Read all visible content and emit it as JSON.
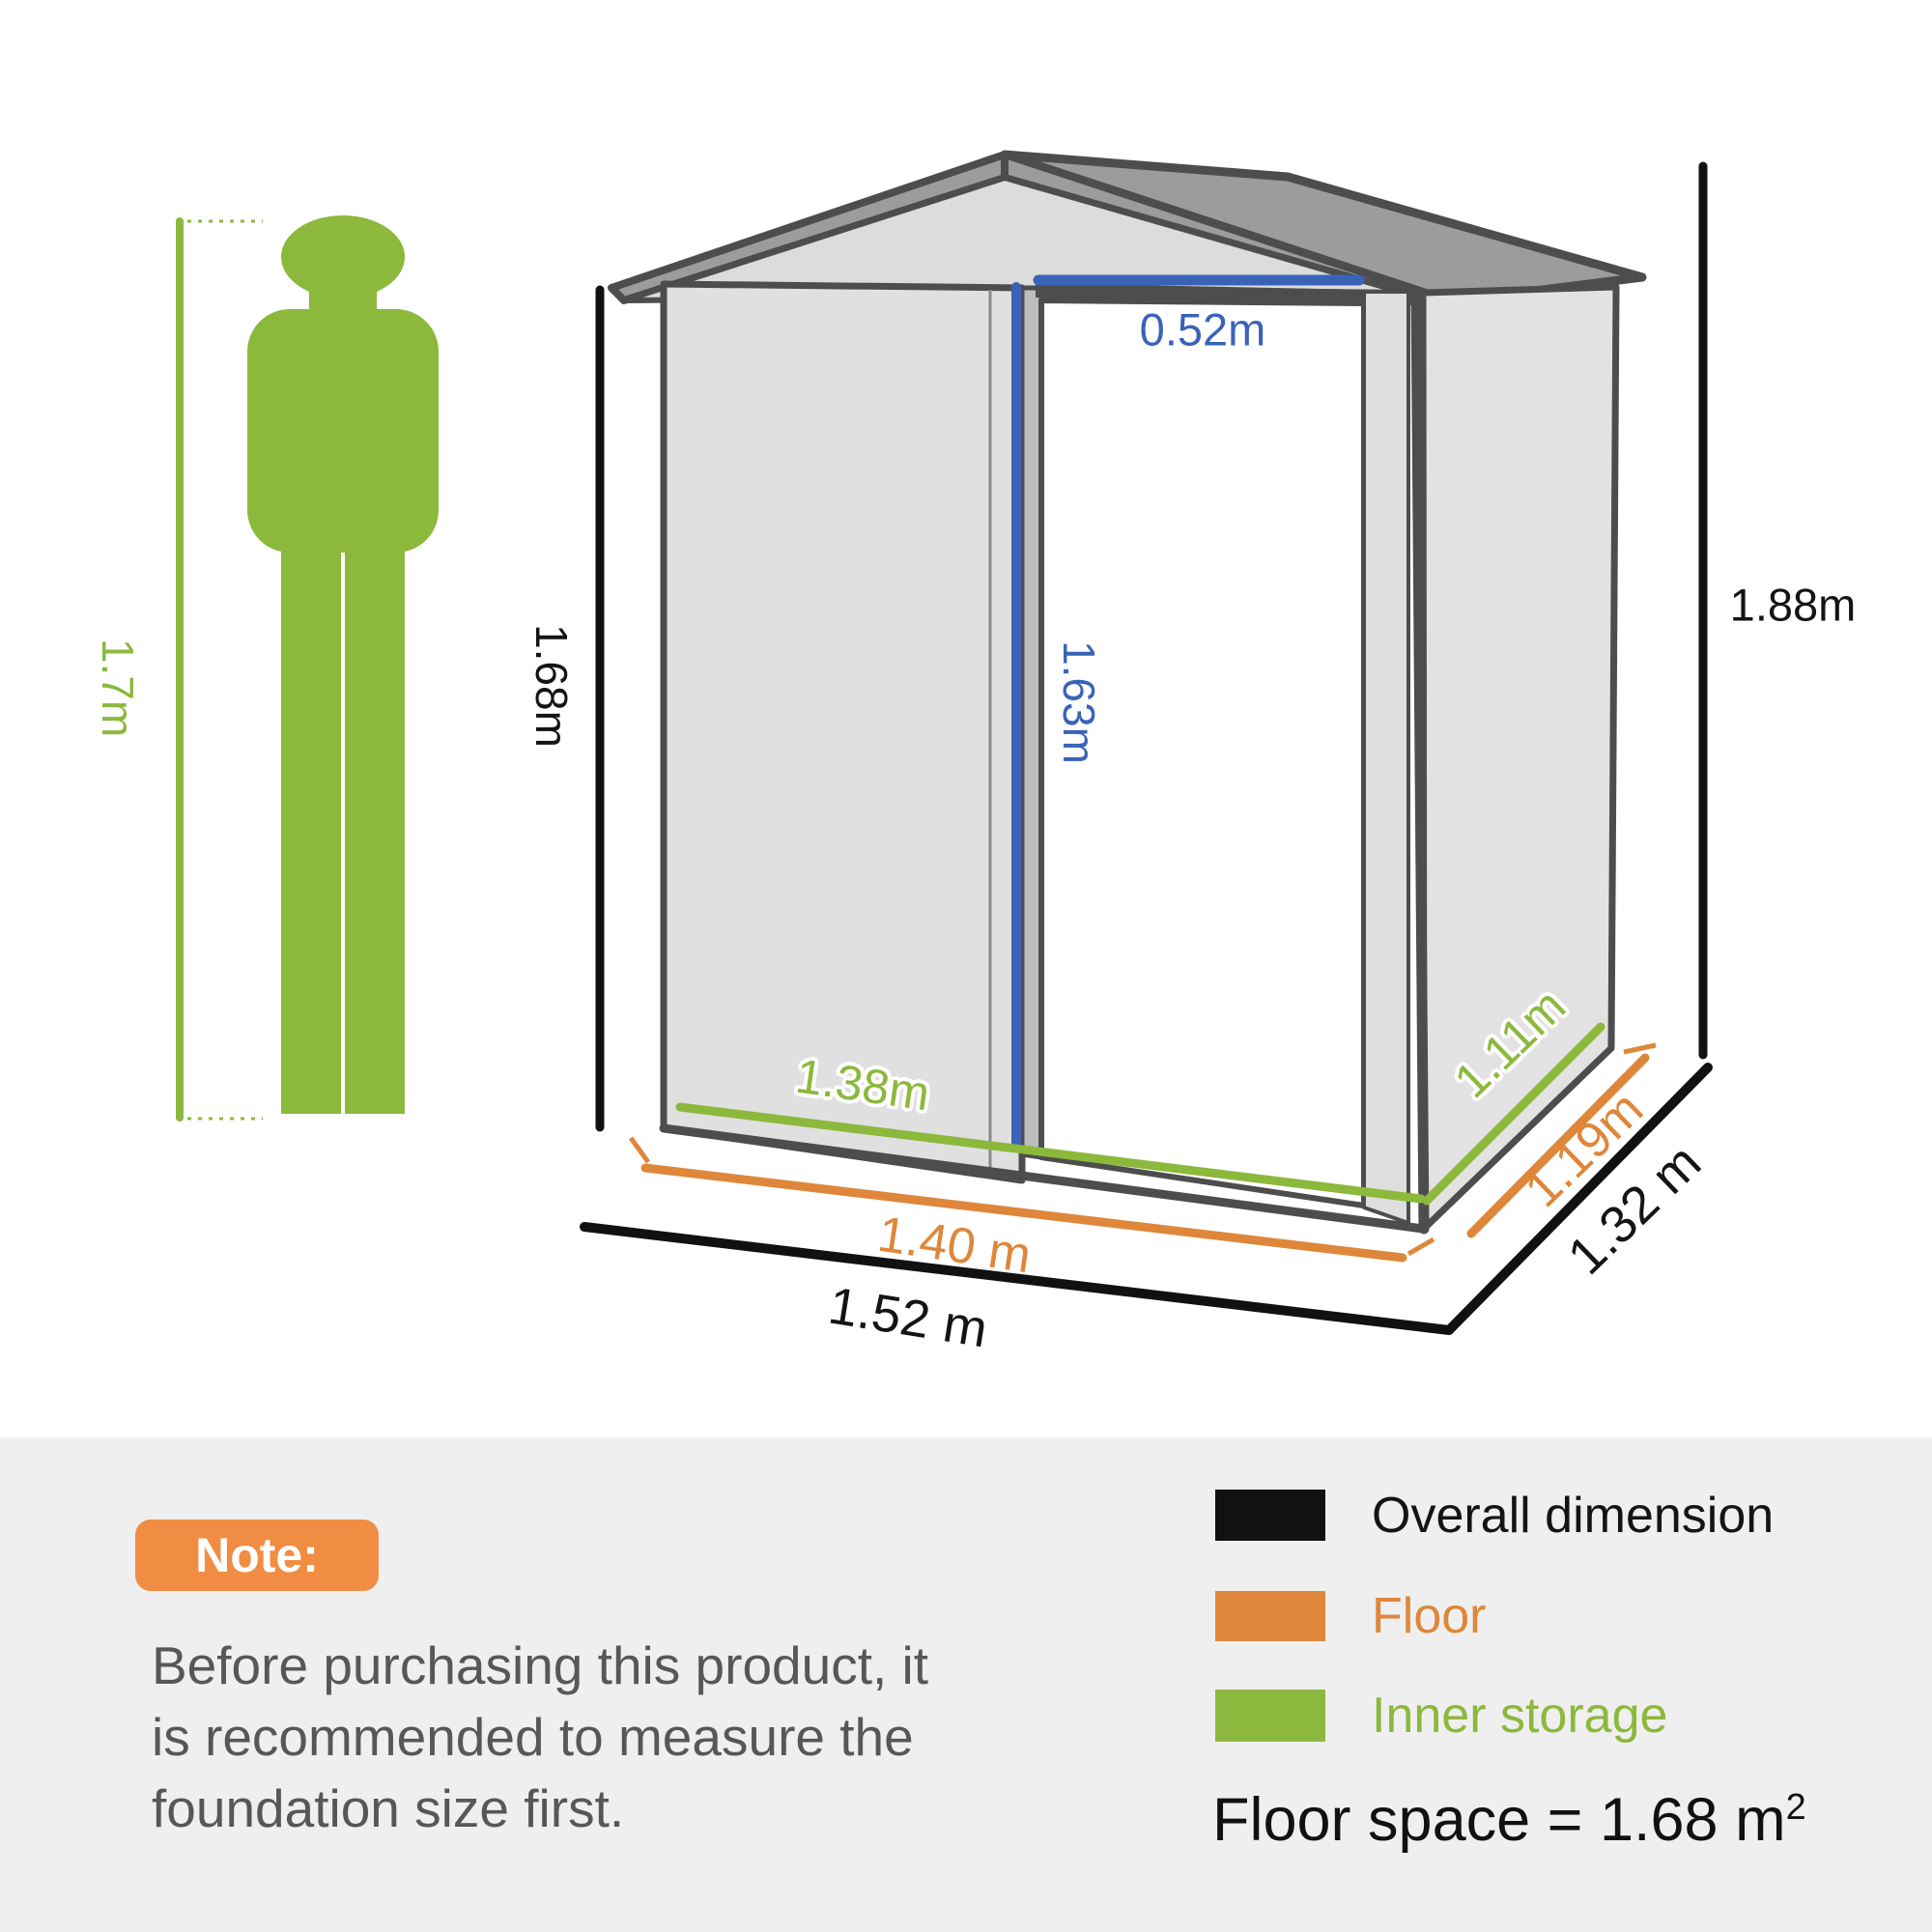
{
  "figure": {
    "height_label": "1.7m"
  },
  "dimensions": {
    "door_width": "0.52m",
    "inner_height": "1.68m",
    "door_height": "1.63m",
    "overall_height": "1.88m",
    "inner_width": "1.38m",
    "floor_width": "1.40 m",
    "overall_width": "1.52 m",
    "inner_depth": "1.11m",
    "floor_depth": "1.19m",
    "overall_depth": "1.32 m"
  },
  "note": {
    "badge": "Note:",
    "lines": [
      "Before purchasing this product, it",
      "is recommended to measure the",
      "foundation size first."
    ]
  },
  "legend": {
    "items": [
      {
        "label": "Overall dimension",
        "color": "#111111"
      },
      {
        "label": "Floor",
        "color": "#DE873B"
      },
      {
        "label": "Inner storage",
        "color": "#8CB83D"
      }
    ],
    "floor_space_text": "Floor space = 1.68 m",
    "floor_space_exponent": "2"
  },
  "colors": {
    "overall_dimension": "#111111",
    "floor": "#DE873B",
    "inner_storage": "#8CB83D",
    "door_dimension": "#3A63B8",
    "person": "#8CB83C",
    "shed_outline": "#4D4D4D",
    "wall_fill": "#E0E0E0",
    "roof_fill": "#9C9C9C",
    "note_badge": "#F08D42",
    "panel_background": "#EFEFEF"
  }
}
